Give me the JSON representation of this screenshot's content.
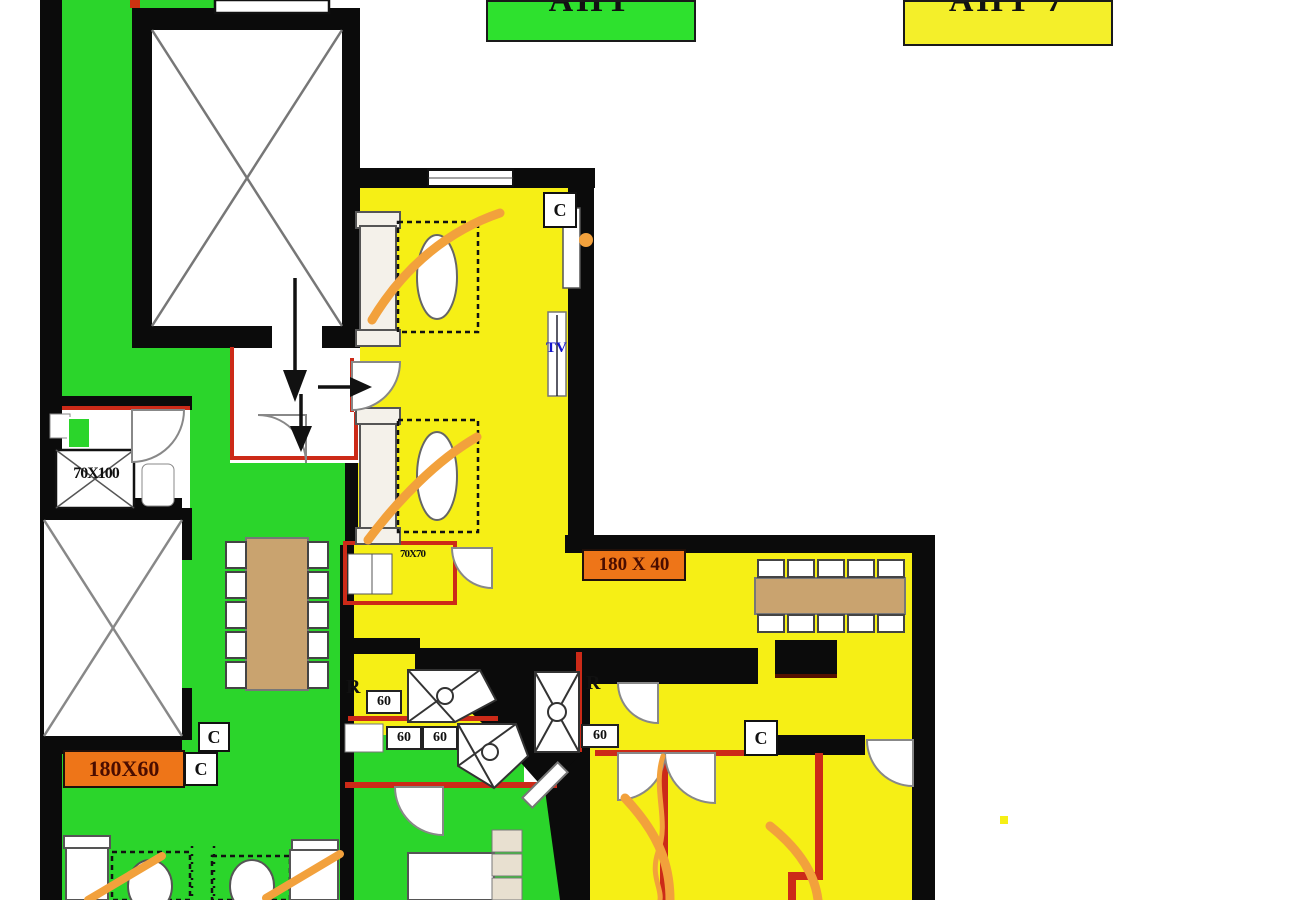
{
  "badges": {
    "green": {
      "text": "АПТ",
      "fill": "#2EE12E"
    },
    "yellow": {
      "text": "АПТ 7",
      "fill": "#F4EF2A"
    }
  },
  "dimensions": {
    "bathtub": "70X100",
    "hall": "180 X 40",
    "room_left": "180X60",
    "kitchen": "70X70"
  },
  "markers": {
    "c_labels": [
      "C",
      "C",
      "C",
      "C"
    ],
    "r_labels": [
      "R",
      "R"
    ],
    "sixty_labels": [
      "60",
      "60",
      "60",
      "60"
    ],
    "tv": "TV"
  },
  "colors": {
    "zone_green": "#2BD52B",
    "zone_yellow": "#F6EF15",
    "label_orange": "#EE7518",
    "wall_black": "#0B0B0B",
    "wall_red": "#CC2A18",
    "swing_orange": "#F2A13C",
    "table_tan": "#C9A36F",
    "tv_blue": "#1414CC"
  }
}
